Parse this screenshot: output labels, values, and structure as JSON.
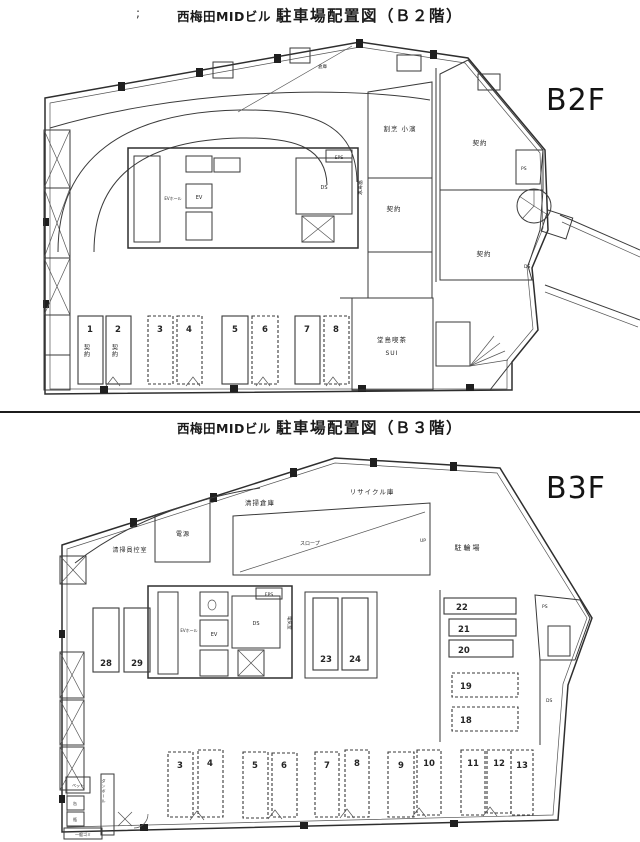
{
  "document": {
    "header": {
      "stray_mark": ";",
      "b2f_title_building": "西梅田MIDビル",
      "b2f_title_main": "駐車場配置図（Ｂ２階）",
      "b3f_title_building": "西梅田MIDビル",
      "b3f_title_main": "駐車場配置図（Ｂ３階）"
    },
    "b2f": {
      "floor_label": "B2F",
      "rooms": {
        "kappo": "割烹 小濱",
        "tenant_a": "契約",
        "tenant_b": "契約",
        "tenant_c": "契約",
        "cafe": "堂島喫茶",
        "cafe_sub": "SUI",
        "souko": "倉庫"
      },
      "core": {
        "ev_hall": "EVホール",
        "ev": "EV",
        "ds": "DS",
        "eps": "EPS",
        "denki": "電気室",
        "ps": "PS",
        "ds_right": "DS",
        "up": "UP"
      },
      "stall_tag": "契約",
      "stalls": [
        "1",
        "2",
        "3",
        "4",
        "5",
        "6",
        "7",
        "8"
      ]
    },
    "b3f": {
      "floor_label": "B3F",
      "rooms": {
        "seisou_souko": "清掃倉庫",
        "recycle": "リサイクル庫",
        "hikaeshitsu": "清掃員控室",
        "dengen": "電源",
        "slope": "スロープ",
        "churinjo": "駐輪場"
      },
      "core": {
        "ev_hall": "EVホール",
        "ev": "EV",
        "ds": "DS",
        "eps": "EPS",
        "denki": "電気室",
        "ps": "PS",
        "ds_right": "DS",
        "up": "UP"
      },
      "waste": {
        "pet": "ペット",
        "kan": "缶",
        "bin": "瓶",
        "ippan": "一般ゴミ",
        "danboru": "ダンボール"
      },
      "stalls_left": [
        "28",
        "29"
      ],
      "stalls_mid": [
        "23",
        "24"
      ],
      "stalls_right": [
        "22",
        "21",
        "20",
        "19",
        "18"
      ],
      "stalls_bottom": [
        "3",
        "4",
        "5",
        "6",
        "7",
        "8",
        "9",
        "10",
        "11",
        "12",
        "13"
      ]
    }
  }
}
